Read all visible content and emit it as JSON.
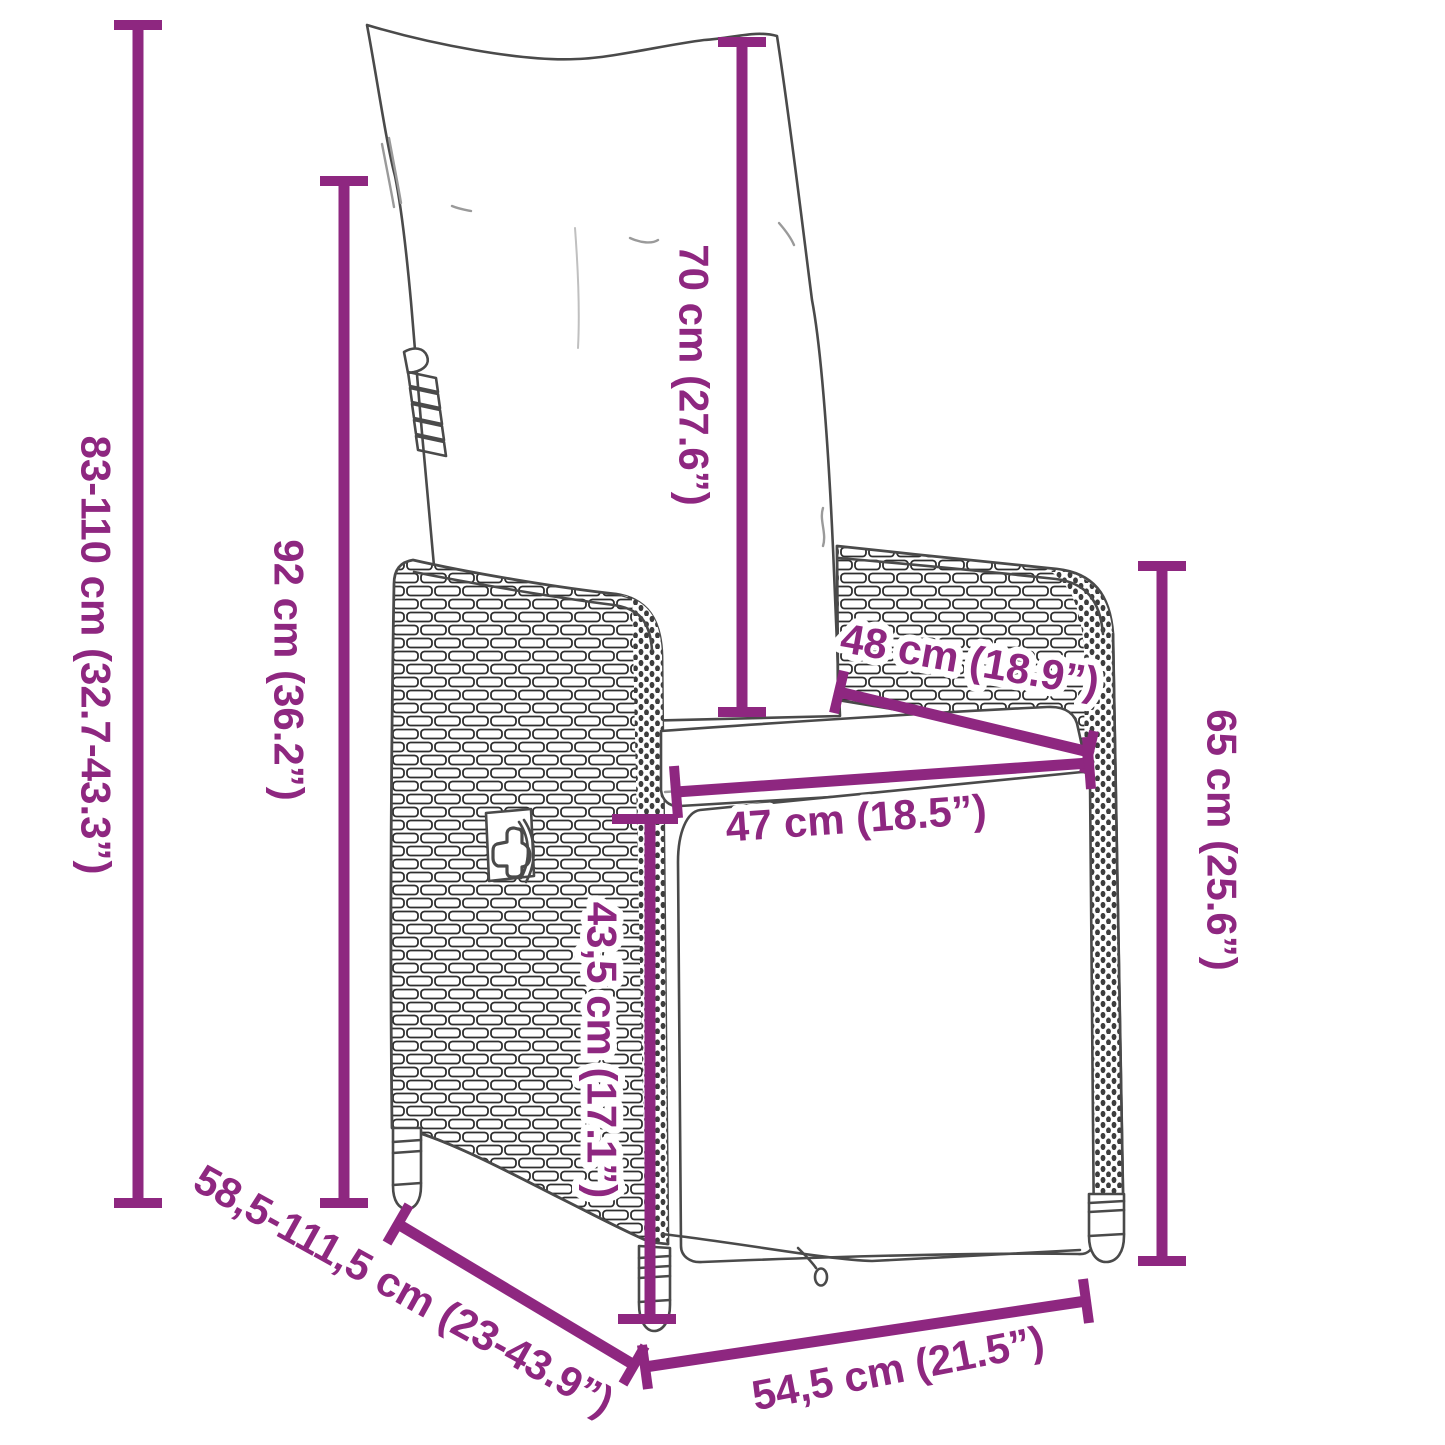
{
  "diagram": {
    "subject": "reclining garden chair with cushion",
    "accent_color": "#8e2780",
    "outline_color": "#4a4a4a",
    "background_color": "#ffffff",
    "dimensions": {
      "overall_height": {
        "label": "83-110 cm (32.7-43.3”)"
      },
      "backrest_height": {
        "label": "92 cm (36.2”)"
      },
      "back_cushion_height": {
        "label": "70 cm (27.6”)"
      },
      "armrest_depth": {
        "label": "48 cm (18.9”)"
      },
      "seat_width": {
        "label": "47 cm (18.5”)"
      },
      "seat_height": {
        "label": "43,5 cm (17.1”)"
      },
      "armrest_height": {
        "label": "65 cm (25.6”)"
      },
      "reclined_depth": {
        "label": "58,5-111,5 cm (23-43.9”)"
      },
      "base_width": {
        "label": "54,5 cm (21.5”)"
      }
    }
  }
}
